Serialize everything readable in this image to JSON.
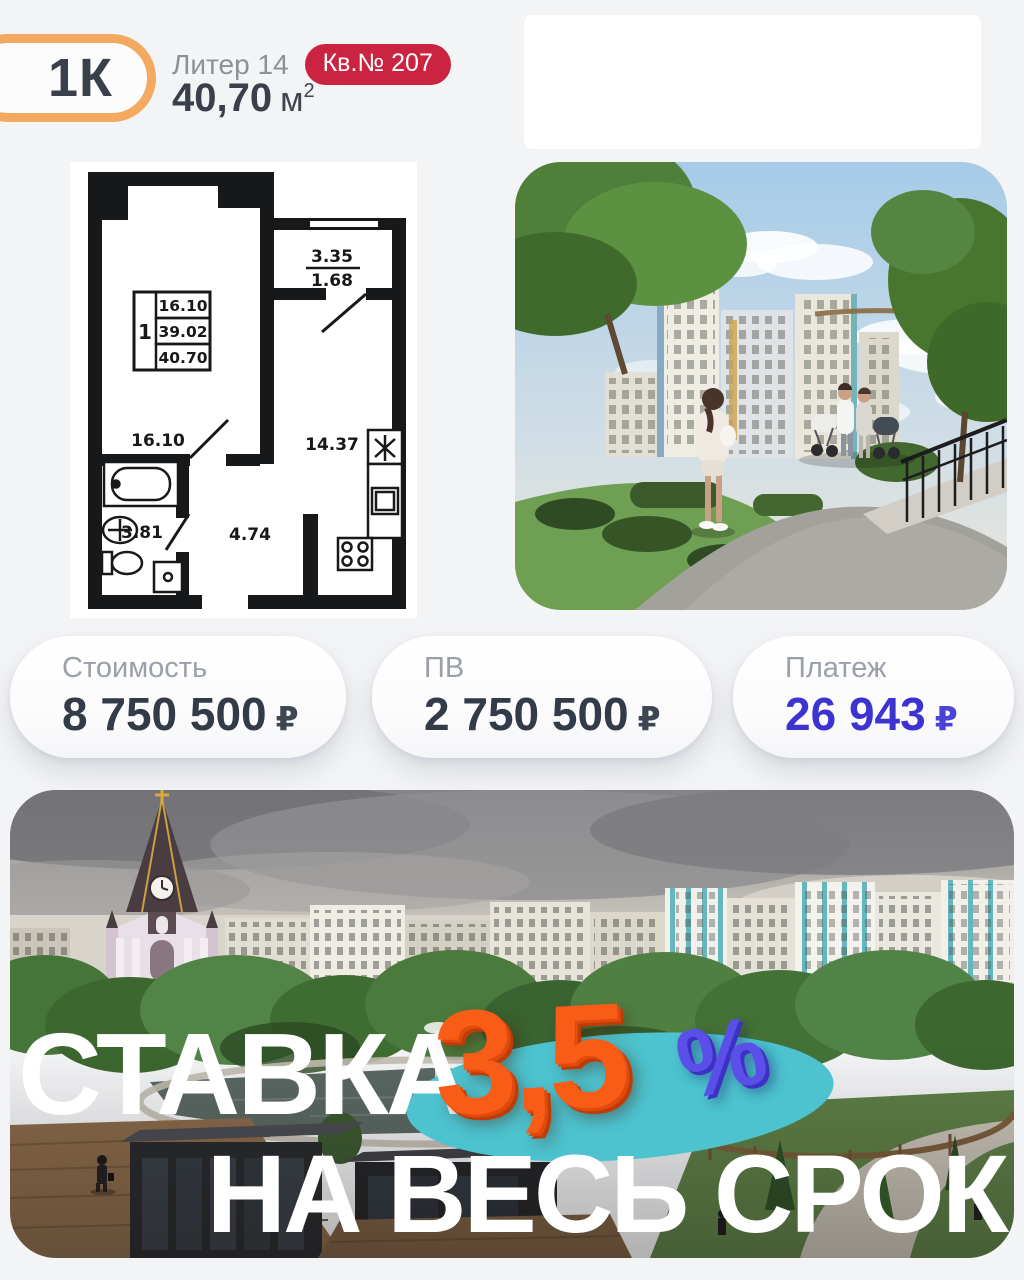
{
  "header": {
    "rooms_label": "1К",
    "liter_label": "Литер 14",
    "apt_label": "Кв.№ 207",
    "area_value": "40,70",
    "area_unit": "м",
    "area_exp": "2"
  },
  "floor_plan": {
    "balcony_top": "3.35",
    "balcony_bottom": "1.68",
    "legend_rooms": "1",
    "legend_living": "16.10",
    "legend_area": "39.02",
    "legend_total": "40.70",
    "living": "16.10",
    "kitchen": "14.37",
    "bathroom": "3.81",
    "hallway": "4.74"
  },
  "cards": [
    {
      "label": "Стоимость",
      "value": "8 750 500",
      "currency": "₽"
    },
    {
      "label": "ПВ",
      "value": "2 750 500",
      "currency": "₽"
    },
    {
      "label": "Платеж",
      "value": "26 943",
      "currency": "₽"
    }
  ],
  "banner": {
    "line1": "СТАВКА",
    "rate": "3,5",
    "percent": "%",
    "line2": "НА ВЕСЬ СРОК"
  },
  "colors": {
    "accent_orange": "#f3aa60",
    "badge_red": "#cb2441",
    "payment_blue": "#3d33d1",
    "rate_orange": "#f85c17",
    "percent_purple": "#5b4fe9",
    "ellipse_teal": "#4cc3cf"
  }
}
